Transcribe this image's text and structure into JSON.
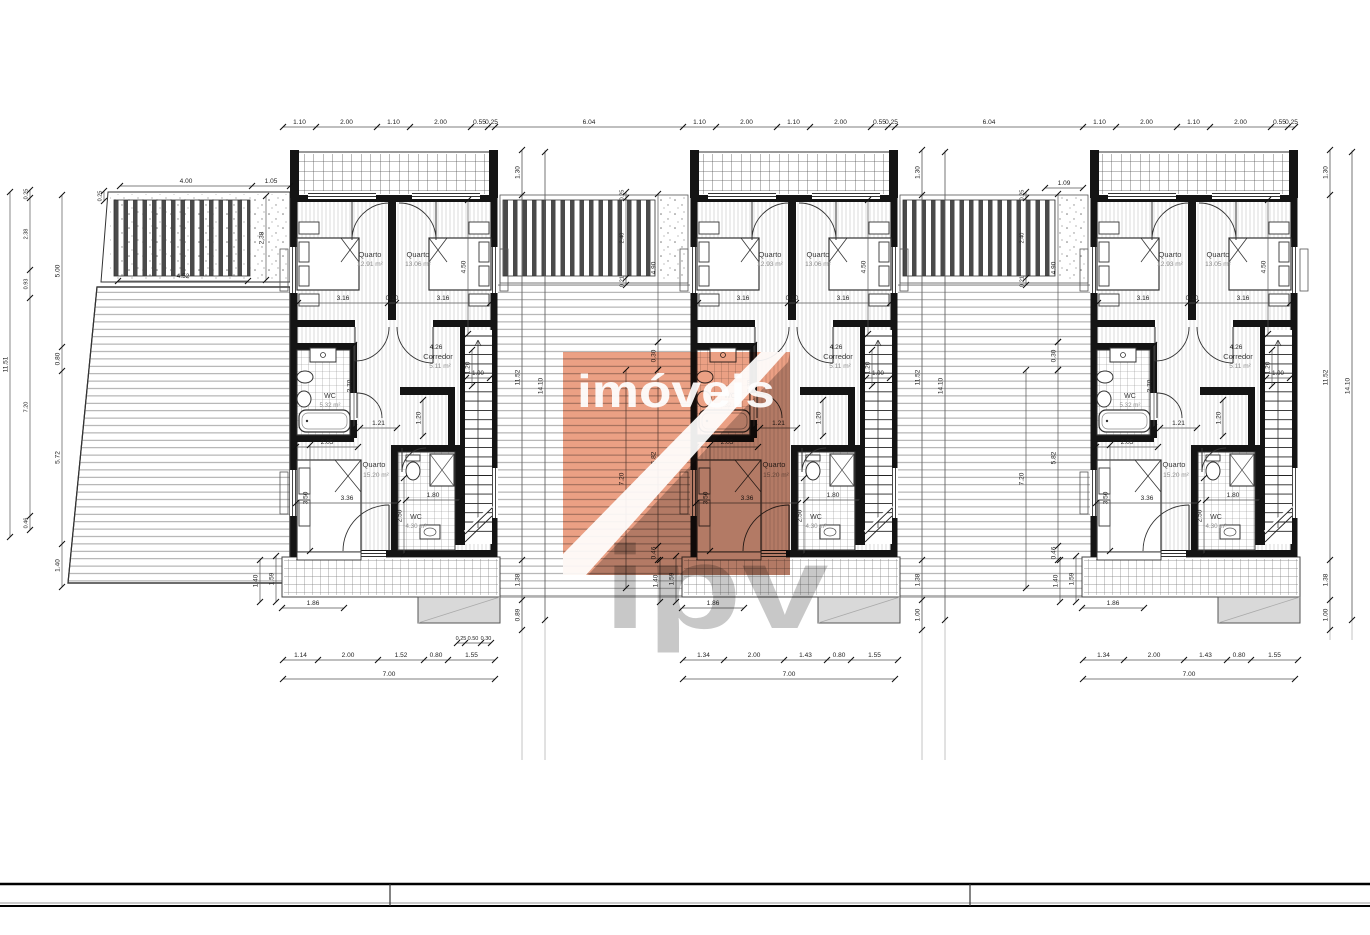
{
  "document": {
    "type": "architectural-floor-plan",
    "description": "First floor plan of three attached dwelling units with terraces and pergolas"
  },
  "colors": {
    "wall": "#141414",
    "dim_line": "#444444",
    "dim_text": "#222222",
    "area_text": "#8a8a8a",
    "room_text": "#3a3a3a",
    "step_gray": "#d9d9d9",
    "watermark_orange": "#eba084",
    "watermark_gray": "#c2c2c2",
    "watermark_letters": "#9b9b9b"
  },
  "watermark": {
    "brand_text": "imóveis",
    "brand_letters": "ipv"
  },
  "units": [
    {
      "id": "unit-1",
      "rooms": {
        "q1": {
          "name": "Quarto",
          "area": "12.91 m²"
        },
        "q2": {
          "name": "Quarto",
          "area": "13.06 m²"
        },
        "corredor": {
          "name": "Corredor",
          "area": "5.11 m²",
          "length": "4.26"
        },
        "q3": {
          "name": "Quarto",
          "area": "15.20 m²"
        },
        "wc1": {
          "name": "WC",
          "area": "5.32 m²"
        },
        "wc2": {
          "name": "WC",
          "area": "4.30 m²"
        }
      },
      "bottom_dims": [
        "1.14",
        "2.00",
        "1.52",
        "0.80",
        "1.55"
      ],
      "bottom_total": "7.00",
      "bottom_small": [
        "0.25",
        "0.50",
        "0.30"
      ]
    },
    {
      "id": "unit-2",
      "rooms": {
        "q1": {
          "name": "Quarto",
          "area": "12.93 m²"
        },
        "q2": {
          "name": "Quarto",
          "area": "13.06 m²"
        },
        "corredor": {
          "name": "Corredor",
          "area": "5.11 m²",
          "length": "4.26"
        },
        "q3": {
          "name": "Quarto",
          "area": "15.20 m²"
        },
        "wc1": {
          "name": "WC",
          "area": "5.32 m²"
        },
        "wc2": {
          "name": "WC",
          "area": "4.30 m²"
        }
      },
      "bottom_dims": [
        "1.34",
        "2.00",
        "1.43",
        "0.80",
        "1.55"
      ],
      "bottom_total": "7.00",
      "bottom_small": []
    },
    {
      "id": "unit-3",
      "rooms": {
        "q1": {
          "name": "Quarto",
          "area": "12.93 m²"
        },
        "q2": {
          "name": "Quarto",
          "area": "13.05 m²"
        },
        "corredor": {
          "name": "Corredor",
          "area": "5.11 m²",
          "length": "4.26"
        },
        "q3": {
          "name": "Quarto",
          "area": "15.20 m²"
        },
        "wc1": {
          "name": "WC",
          "area": "5.32 m²"
        },
        "wc2": {
          "name": "WC",
          "area": "4.30 m²"
        }
      },
      "bottom_dims": [
        "1.34",
        "2.00",
        "1.43",
        "0.80",
        "1.55"
      ],
      "bottom_total": "7.00",
      "bottom_small": []
    }
  ],
  "dims": {
    "top_row": [
      "1.10",
      "2.00",
      "1.10",
      "2.00",
      "0.55",
      "0.25"
    ],
    "top_gap": "6.04",
    "pre_unit3": "1.09",
    "bed_row": [
      "3.16",
      "0.10",
      "3.16"
    ],
    "bed_depth": "4.50",
    "corridor_w": "1.20",
    "one_meter": "1.00",
    "wc1_depth": "2.70",
    "hall_w": "1.21",
    "nook": "1.20",
    "wc1_w": "2.05",
    "q3_w": "3.36",
    "q3_d": "3.50",
    "q3_s": "2.50",
    "wc2_w": "1.80",
    "deck_width": "1.86",
    "deck_v1": "1.40",
    "deck_v2": "1.59",
    "gap_col_a": [
      "1.30",
      "11.52",
      "1.38",
      "1.00"
    ],
    "gap_col_a_unit1_last": "0.89",
    "gap_col_b": "14.10",
    "gap_slats": [
      "0.25",
      "2.40",
      "0.21"
    ],
    "gap_col_right": [
      "4.90",
      "0.30",
      "5.82",
      "0.46"
    ],
    "gap_col_left7": "7.20",
    "terrace_top": [
      "4.00",
      "1.05"
    ],
    "terrace_small": "0.25",
    "terrace_inner": "4.52",
    "terrace_depth": "2.38",
    "left_col_total": "11.51",
    "left_col1": [
      "0.25",
      "2.38",
      "0.93",
      "7.20",
      "0.46"
    ],
    "left_col2": [
      "5.00",
      "0.80",
      "5.72",
      "1.40"
    ]
  },
  "title_block": {
    "cells": [
      "",
      "",
      ""
    ]
  }
}
